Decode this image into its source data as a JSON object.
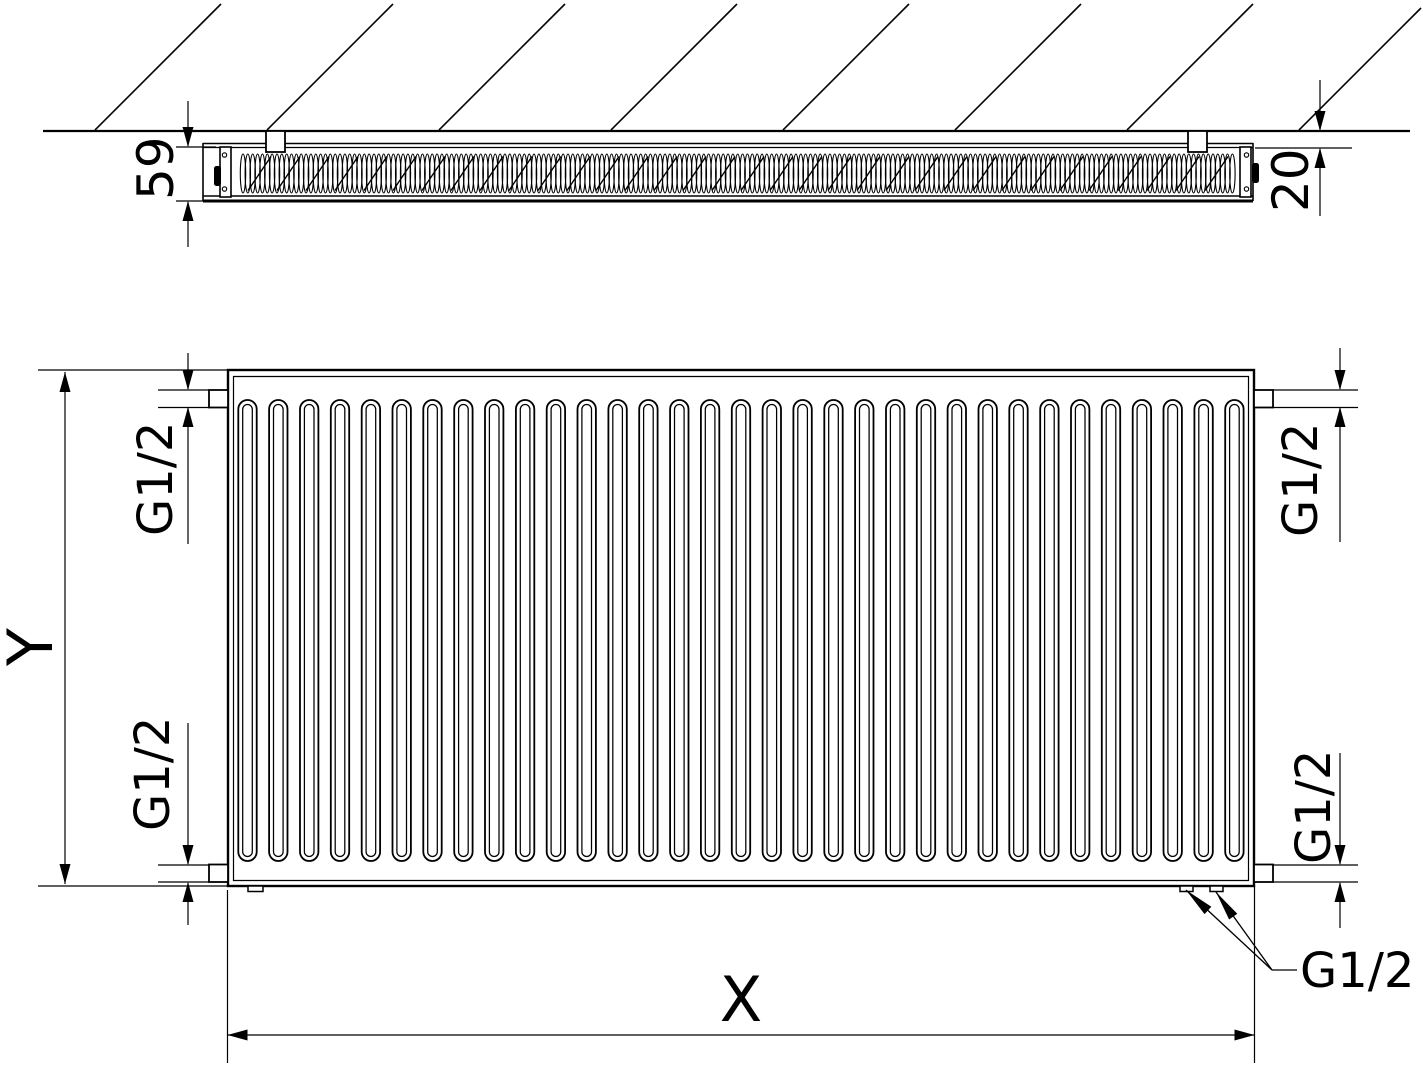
{
  "drawing": {
    "top_view": {
      "depth_mm": "59",
      "wall_gap_mm": "20"
    },
    "front_view": {
      "height_label": "Y",
      "width_label": "X",
      "thread_top_left": "G1/2",
      "thread_top_right": "G1/2",
      "thread_bottom_left": "G1/2",
      "thread_bottom_right": "G1/2",
      "thread_bottom_connections": "G1/2"
    },
    "colors": {
      "line": "#000000",
      "background": "#ffffff"
    }
  }
}
